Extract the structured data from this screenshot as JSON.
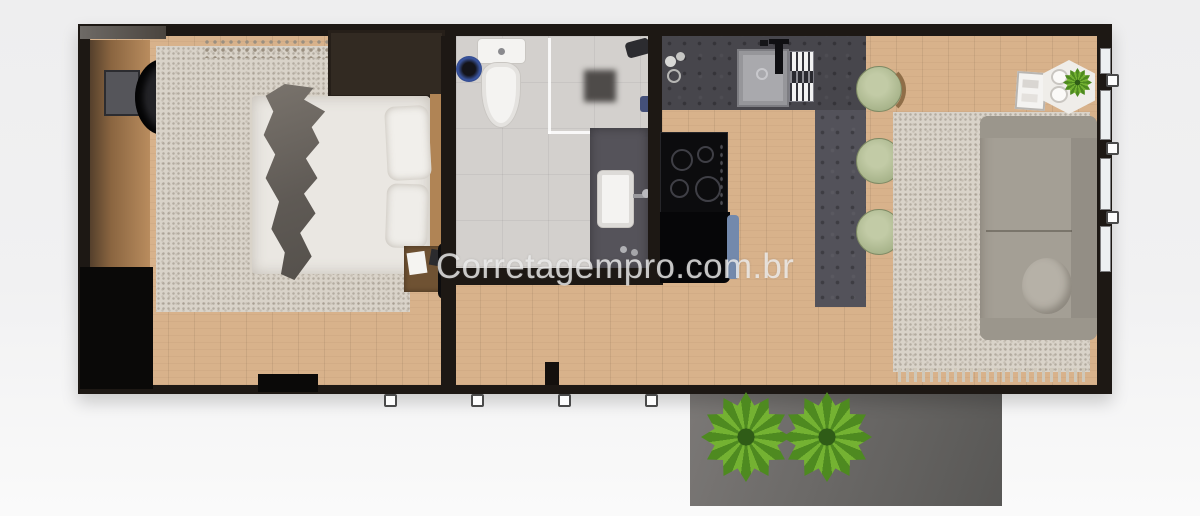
{
  "watermark": {
    "text": "Corretagempro.com.br",
    "color": "rgba(240,240,240,0.8)"
  },
  "floor_plan": {
    "type": "tiny-house apartment, rendered top-down view",
    "rooms": [
      {
        "id": "bedroom",
        "objects": [
          "wood console with tv",
          "desk chair",
          "black wardrobe",
          "beige area rug with fringe",
          "double bed",
          "gray throw blanket",
          "two white pillows",
          "dark headboard cabinet",
          "wood nightstand with note",
          "black floor lamp"
        ]
      },
      {
        "id": "bathroom",
        "objects": [
          "toilet",
          "blue waste bin",
          "walk-in shower with glass partition",
          "floor drain",
          "shower head",
          "dark vanity with white rectangular sink and faucet"
        ]
      },
      {
        "id": "kitchen",
        "objects": [
          "dark tiled counter",
          "stainless sink with faucet",
          "dish rack",
          "4-burner cooktop",
          "black appliance with blue towel",
          "bar counter"
        ]
      },
      {
        "id": "living_room",
        "objects": [
          "three green bar stools",
          "beige area rug with fringe",
          "gray sofa with round cushion",
          "hexagonal side table with plant and two cups",
          "white mini cabinet",
          "windows on right wall"
        ]
      }
    ],
    "exterior": {
      "deck": "gray wooden deck",
      "deck_plants": 2,
      "anchors_bottom": 4,
      "anchors_right": 3
    },
    "counts": {
      "bar_stools": 3,
      "cooktop_burners": 4,
      "bed_pillows": 2,
      "window_panes_right": 4
    },
    "colors": {
      "background": "#f1f1f2",
      "wall": "#1d1814",
      "wood_floor": "#d8b28b",
      "bedroom_rug": "#d9d3c9",
      "living_rug": "#d9d3c9",
      "bathroom_floor": "#d3d0cd",
      "kitchen_counter": "#47464c",
      "bar_counter": "#53525a",
      "cooktop": "#0c0c0e",
      "appliance_blue": "#7389ac",
      "stool_green": "#a9b58c",
      "sofa": "#a49f95",
      "blanket_gray": "#68635e",
      "deck_gray": "#6b6967",
      "plant_green": "#74b232"
    }
  }
}
